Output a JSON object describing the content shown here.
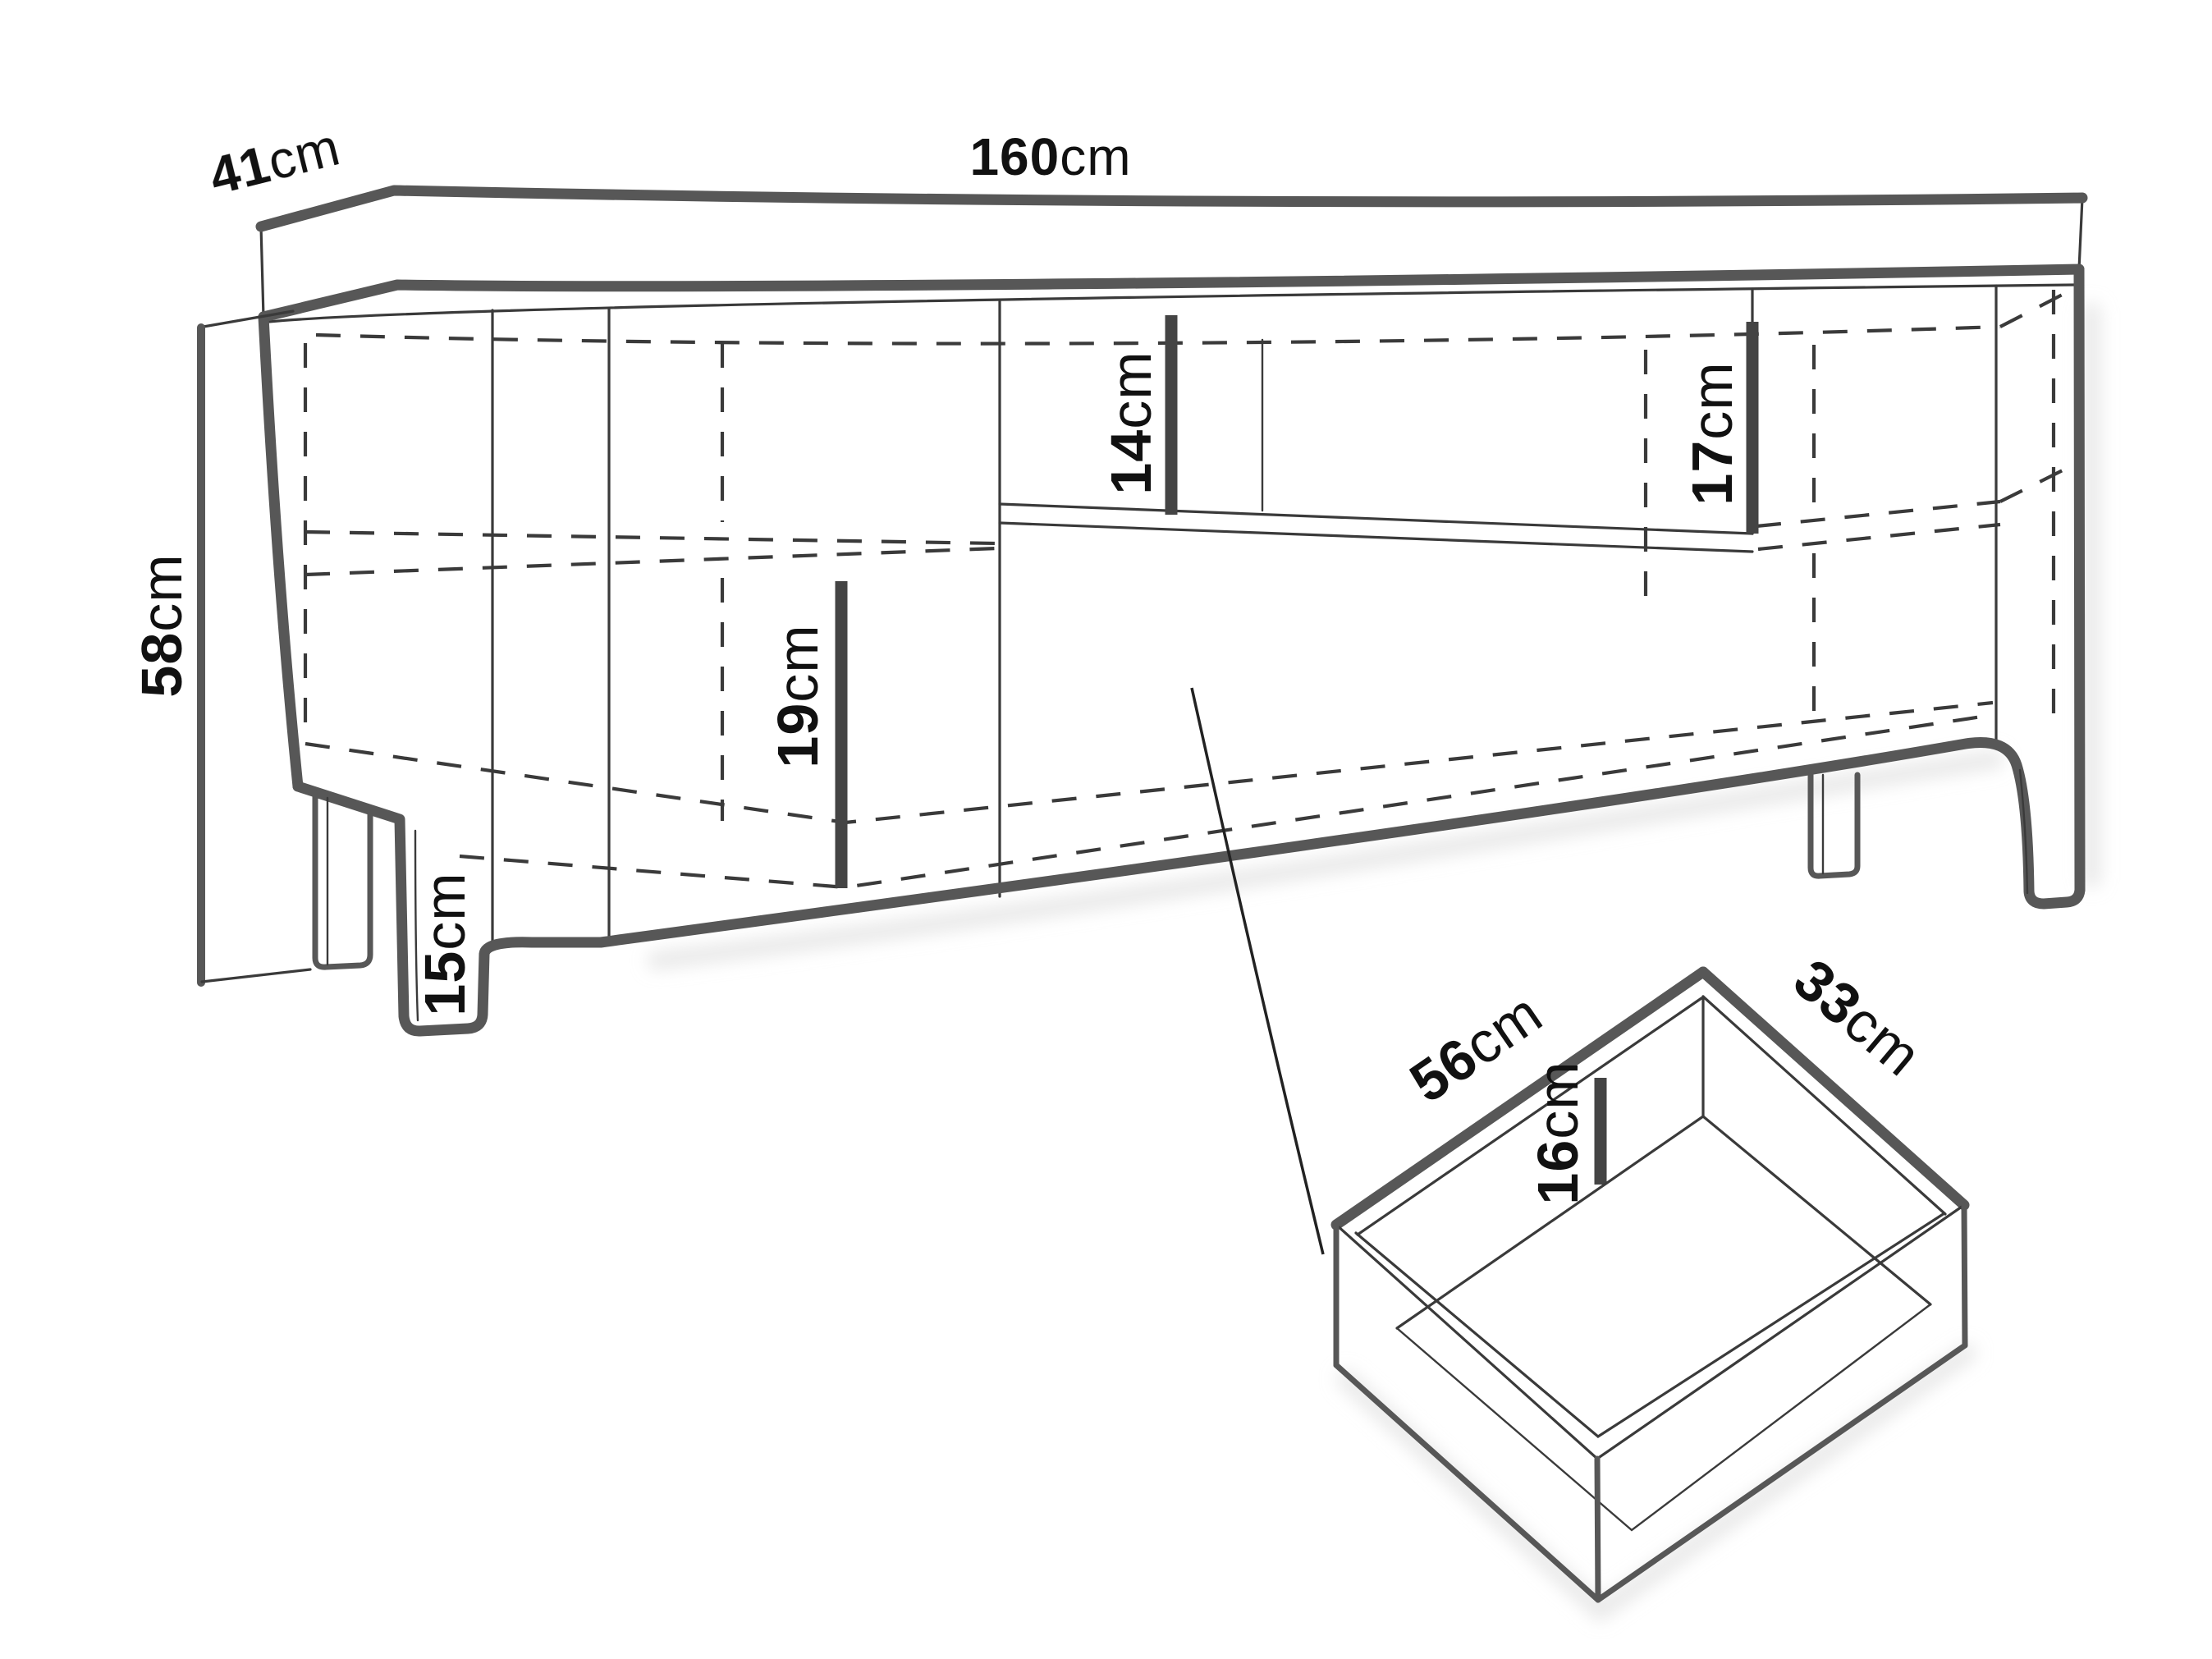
{
  "labels": {
    "width": {
      "value": "160",
      "unit": "cm"
    },
    "depth": {
      "value": "41",
      "unit": "cm"
    },
    "height": {
      "value": "58",
      "unit": "cm"
    },
    "niche_height_left": {
      "value": "14",
      "unit": "cm"
    },
    "niche_height_right": {
      "value": "17",
      "unit": "cm"
    },
    "shelf_compartment_height": {
      "value": "19",
      "unit": "cm"
    },
    "leg_height": {
      "value": "15",
      "unit": "cm"
    },
    "drawer_width": {
      "value": "56",
      "unit": "cm"
    },
    "drawer_depth": {
      "value": "33",
      "unit": "cm"
    },
    "drawer_inner_height": {
      "value": "16",
      "unit": "cm"
    }
  },
  "colors": {
    "outline_thick": "#575757",
    "line_thin": "#3a3a3a",
    "dash": "#3a3a3a",
    "dimension_bar": "#444444",
    "text": "#111111",
    "background": "#ffffff",
    "shadow": "#d9d9d9"
  }
}
